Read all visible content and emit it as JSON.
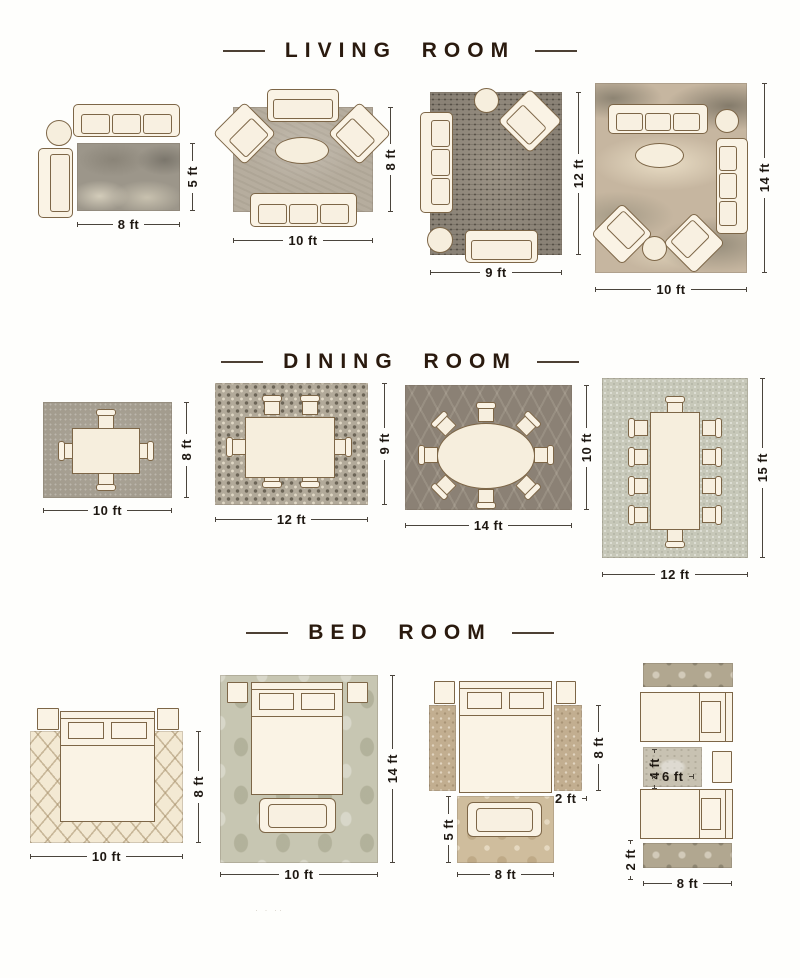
{
  "colors": {
    "accent_text": "#2a1a0e",
    "dimension_text": "#1e1812",
    "furniture_fill": "#faf3e5",
    "furniture_outline": "#7d6647"
  },
  "watermark": "· · ··",
  "sections": [
    {
      "title": "LIVING ROOM",
      "layouts": [
        {
          "furniture": [
            "sofa",
            "chaise",
            "round-side-table"
          ],
          "rug": "gray-abstract",
          "width_label": "8 ft",
          "height_label": "5 ft"
        },
        {
          "furniture": [
            "loveseat",
            "armchair",
            "armchair",
            "oval-coffee-table",
            "sofa"
          ],
          "rug": "warm-gray",
          "width_label": "10 ft",
          "height_label": "8 ft"
        },
        {
          "furniture": [
            "sofa",
            "round-side-table",
            "armchair",
            "round-side-table",
            "loveseat"
          ],
          "rug": "charcoal-distressed",
          "width_label": "9 ft",
          "height_label": "12 ft"
        },
        {
          "furniture": [
            "sofa",
            "round-side-table",
            "sofa",
            "oval-coffee-table",
            "armchair",
            "armchair",
            "round-side-table"
          ],
          "rug": "beige-abstract",
          "width_label": "10 ft",
          "height_label": "14 ft"
        }
      ]
    },
    {
      "title": "DINING ROOM",
      "layouts": [
        {
          "furniture": [
            "dining-table",
            "4-chairs"
          ],
          "rug": "gray-speckled",
          "width_label": "10 ft",
          "height_label": "8 ft"
        },
        {
          "furniture": [
            "dining-table",
            "6-chairs"
          ],
          "rug": "mosaic-dot",
          "width_label": "12 ft",
          "height_label": "9 ft"
        },
        {
          "furniture": [
            "oval-dining-table",
            "8-chairs"
          ],
          "rug": "dark-trellis",
          "width_label": "14 ft",
          "height_label": "10 ft"
        },
        {
          "furniture": [
            "long-dining-table",
            "10-chairs"
          ],
          "rug": "light-gray",
          "width_label": "12 ft",
          "height_label": "15 ft"
        }
      ]
    },
    {
      "title": "BED ROOM",
      "layouts": [
        {
          "furniture": [
            "bed",
            "2-nightstands"
          ],
          "rug": "cream-diamond",
          "width_label": "10 ft",
          "height_label": "8 ft"
        },
        {
          "furniture": [
            "bed",
            "2-nightstands",
            "bench"
          ],
          "rug": "sage-damask",
          "width_label": "10 ft",
          "height_label": "14 ft"
        },
        {
          "furniture": [
            "bed",
            "2-nightstands",
            "bench"
          ],
          "rug": "tan-floral",
          "width_label": "8 ft",
          "height_label": "5 ft",
          "runner_height_label": "8 ft",
          "runner_width_label": "2 ft"
        },
        {
          "furniture": [
            "twin-bed",
            "twin-bed",
            "nightstand"
          ],
          "rug": "patterned-runners",
          "width_label": "8 ft",
          "runner_width_label": "2 ft",
          "center_rug_width_label": "6 ft",
          "center_rug_height_label": "4 ft"
        }
      ]
    }
  ]
}
